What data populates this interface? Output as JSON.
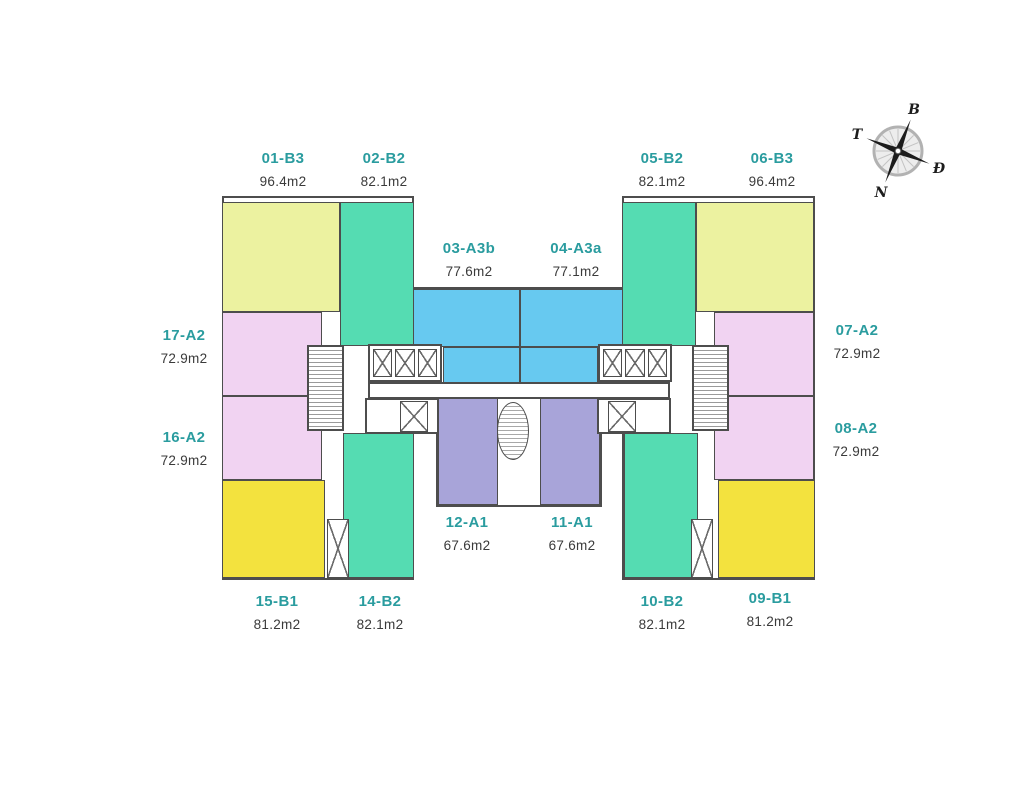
{
  "compass": {
    "labels": {
      "north": "B",
      "west": "T",
      "east": "Đ",
      "south": "N"
    },
    "rotation_deg": 22
  },
  "floorplan": {
    "wall_color": "#4d4d4d",
    "label_color": "#2a9c9f",
    "area_color": "#3a3a3a",
    "units": [
      {
        "code": "01-B3",
        "area": "96.4m2",
        "color": "#ecf2a0",
        "rects": [
          [
            222,
            202,
            118,
            110
          ]
        ],
        "label": [
          283,
          150
        ]
      },
      {
        "code": "02-B2",
        "area": "82.1m2",
        "color": "#55dcb2",
        "rects": [
          [
            340,
            202,
            74,
            144
          ]
        ],
        "label": [
          384,
          150
        ]
      },
      {
        "code": "03-A3b",
        "area": "77.6m2",
        "color": "#67c9f0",
        "rects": [
          [
            413,
            289,
            107,
            58
          ],
          [
            443,
            347,
            77,
            36
          ]
        ],
        "label": [
          469,
          240
        ]
      },
      {
        "code": "04-A3a",
        "area": "77.1m2",
        "color": "#67c9f0",
        "rects": [
          [
            520,
            289,
            108,
            58
          ],
          [
            520,
            347,
            78,
            36
          ]
        ],
        "label": [
          576,
          240
        ]
      },
      {
        "code": "05-B2",
        "area": "82.1m2",
        "color": "#55dcb2",
        "rects": [
          [
            622,
            202,
            74,
            144
          ]
        ],
        "label": [
          662,
          150
        ]
      },
      {
        "code": "06-B3",
        "area": "96.4m2",
        "color": "#ecf2a0",
        "rects": [
          [
            696,
            202,
            118,
            110
          ]
        ],
        "label": [
          772,
          150
        ]
      },
      {
        "code": "07-A2",
        "area": "72.9m2",
        "color": "#f1d3f2",
        "rects": [
          [
            714,
            312,
            100,
            84
          ]
        ],
        "label": [
          857,
          322
        ]
      },
      {
        "code": "08-A2",
        "area": "72.9m2",
        "color": "#f1d3f2",
        "rects": [
          [
            714,
            396,
            100,
            84
          ]
        ],
        "label": [
          856,
          420
        ]
      },
      {
        "code": "09-B1",
        "area": "81.2m2",
        "color": "#f3e23e",
        "rects": [
          [
            718,
            480,
            97,
            98
          ]
        ],
        "label": [
          770,
          590
        ]
      },
      {
        "code": "10-B2",
        "area": "82.1m2",
        "color": "#55dcb2",
        "rects": [
          [
            624,
            433,
            74,
            145
          ]
        ],
        "label": [
          662,
          593
        ]
      },
      {
        "code": "11-A1",
        "area": "67.6m2",
        "color": "#a8a4d9",
        "rects": [
          [
            540,
            398,
            60,
            107
          ]
        ],
        "label": [
          572,
          514
        ]
      },
      {
        "code": "12-A1",
        "area": "67.6m2",
        "color": "#a8a4d9",
        "rects": [
          [
            438,
            398,
            60,
            107
          ]
        ],
        "label": [
          467,
          514
        ]
      },
      {
        "code": "14-B2",
        "area": "82.1m2",
        "color": "#55dcb2",
        "rects": [
          [
            343,
            433,
            71,
            145
          ]
        ],
        "label": [
          380,
          593
        ]
      },
      {
        "code": "15-B1",
        "area": "81.2m2",
        "color": "#f3e23e",
        "rects": [
          [
            222,
            480,
            103,
            98
          ]
        ],
        "label": [
          277,
          593
        ]
      },
      {
        "code": "16-A2",
        "area": "72.9m2",
        "color": "#f1d3f2",
        "rects": [
          [
            222,
            396,
            100,
            84
          ]
        ],
        "label": [
          184,
          429
        ]
      },
      {
        "code": "17-A2",
        "area": "72.9m2",
        "color": "#f1d3f2",
        "rects": [
          [
            222,
            312,
            100,
            84
          ]
        ],
        "label": [
          184,
          327
        ]
      }
    ],
    "outlines": [
      [
        222,
        196,
        192,
        384
      ],
      [
        622,
        196,
        193,
        384
      ],
      [
        411,
        287,
        219,
        97
      ],
      [
        436,
        396,
        166,
        111
      ]
    ],
    "corridors": [
      [
        368,
        382,
        302,
        17
      ]
    ],
    "cores": {
      "lift_banks": [
        [
          368,
          344,
          74,
          38
        ],
        [
          598,
          344,
          74,
          38
        ]
      ],
      "lifts_per_bank": 3,
      "stairs": [
        [
          307,
          345,
          37,
          86
        ],
        [
          692,
          345,
          37,
          86
        ]
      ],
      "oval_stair": [
        497,
        402,
        32,
        58
      ],
      "service_boxes": [
        [
          365,
          398,
          74,
          36
        ],
        [
          597,
          398,
          74,
          36
        ]
      ],
      "service_lifts": [
        [
          400,
          401,
          28,
          31
        ],
        [
          608,
          401,
          28,
          31
        ]
      ],
      "shafts": [
        [
          327,
          519,
          22,
          59
        ],
        [
          691,
          519,
          22,
          59
        ]
      ]
    }
  }
}
